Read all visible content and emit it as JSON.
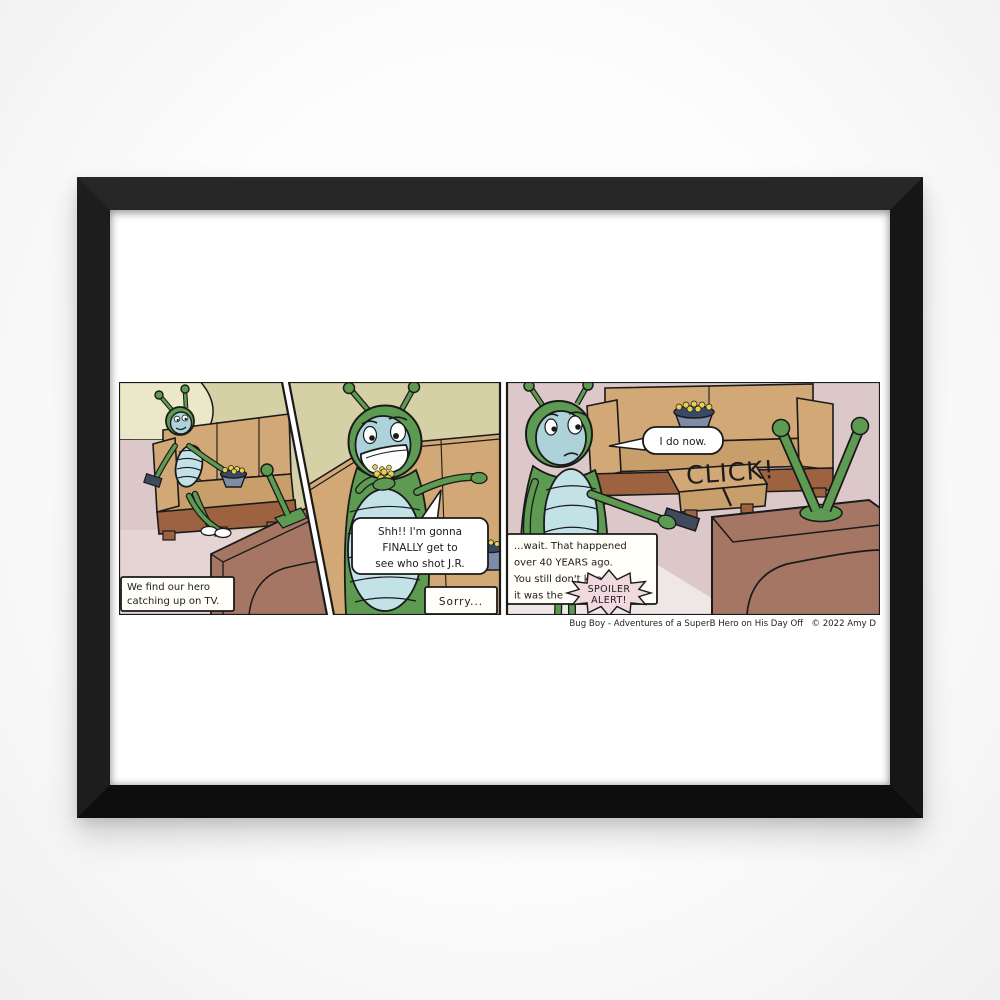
{
  "poster": {
    "type_label": "framed comic strip print",
    "attribution": "Bug Boy - Adventures of a SuperB Hero on His Day Off   © 2022 Amy D"
  },
  "comic": {
    "series_title": "Bug Boy",
    "panel1": {
      "caption1": "We find our hero",
      "caption2": "catching up on TV."
    },
    "panel2": {
      "speech1": "Shh!! I'm gonna",
      "speech2": "FINALLY get to",
      "speech3": "see who shot J.R.",
      "caption": "Sorry..."
    },
    "panel3": {
      "speech": "I do now.",
      "sfx": "CLICK!",
      "caption1": "...wait. That happened",
      "caption2": "over 40 YEARS ago.",
      "caption3": "You still don't know",
      "caption4": "it was the",
      "burst1": "SPOILER",
      "burst2": "ALERT!"
    }
  },
  "colors": {
    "frame_black": "#1a1a1a",
    "matte_white": "#ffffff",
    "bug_green": "#5e9b52",
    "face_blue": "#aed2da",
    "belly_blue": "#c3e2e8",
    "couch_tan": "#d2a876",
    "couch_tan_dark": "#c89e6b",
    "wood_brown": "#9d6240",
    "tv_brown": "#a57663",
    "wall_olive": "#d5d0a5",
    "wall_pink": "#ddc8c9",
    "wall_cream": "#ebe7c9",
    "floor_pink": "#e6d3d4",
    "bowl_slate": "#7e8ca6",
    "bowl_navy": "#3a4a66",
    "popcorn_yellow": "#e6cf4e",
    "burst_pink": "#f2d8df",
    "remote_slate": "#3f4a5e"
  }
}
